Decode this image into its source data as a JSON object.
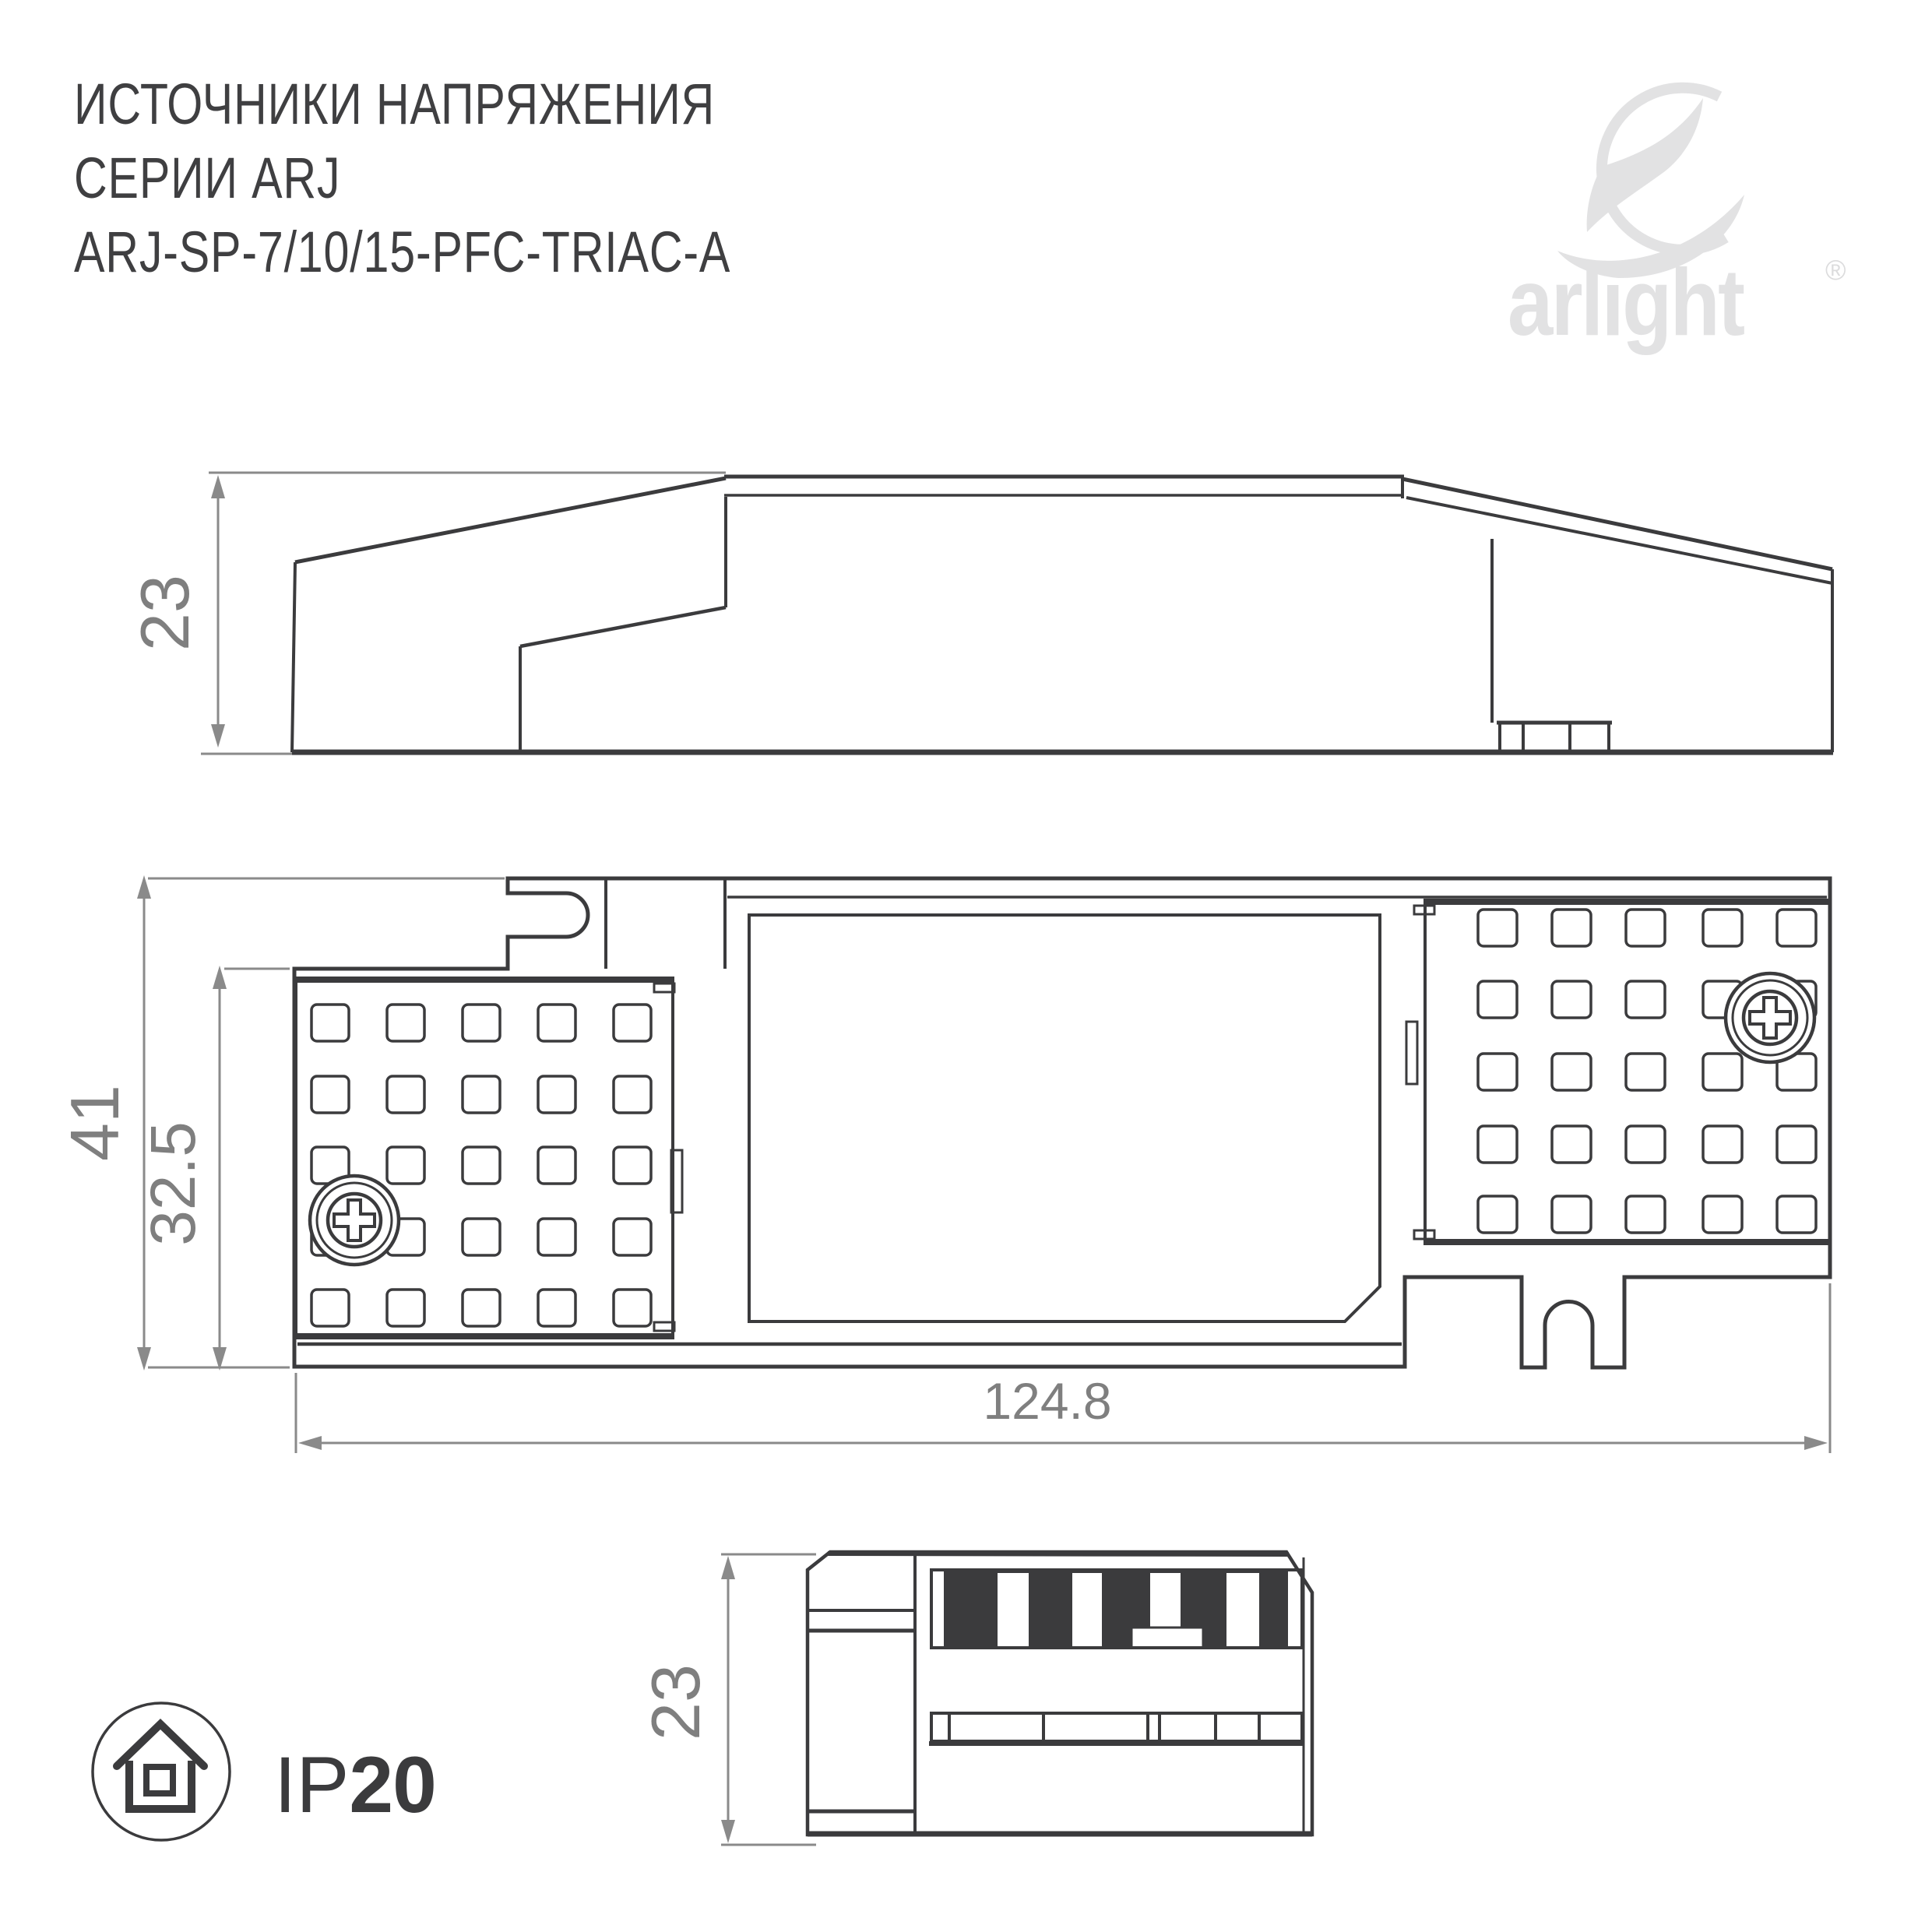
{
  "header": {
    "title_line1": "ИСТОЧНИКИ НАПРЯЖЕНИЯ",
    "title_line2": "СЕРИИ ARJ",
    "title_line3": "ARJ-SP-7/10/15-PFC-TRIAC-A"
  },
  "logo": {
    "brand": "arlight",
    "registered_mark": "®"
  },
  "drawings": {
    "side_view": {
      "height_label": "23"
    },
    "plan_view": {
      "overall_height_label": "41",
      "body_height_label": "32.5",
      "length_label": "124.8"
    },
    "end_view": {
      "height_label": "23"
    }
  },
  "footer": {
    "ip_rating_prefix": "IP",
    "ip_rating_value": "20"
  },
  "colors": {
    "line": "#3b3b3d",
    "dimension_line": "#8a8a8a",
    "dimension_text": "#7f7f7f",
    "logo": "#e2e2e3",
    "title_text": "#3f3f41"
  }
}
